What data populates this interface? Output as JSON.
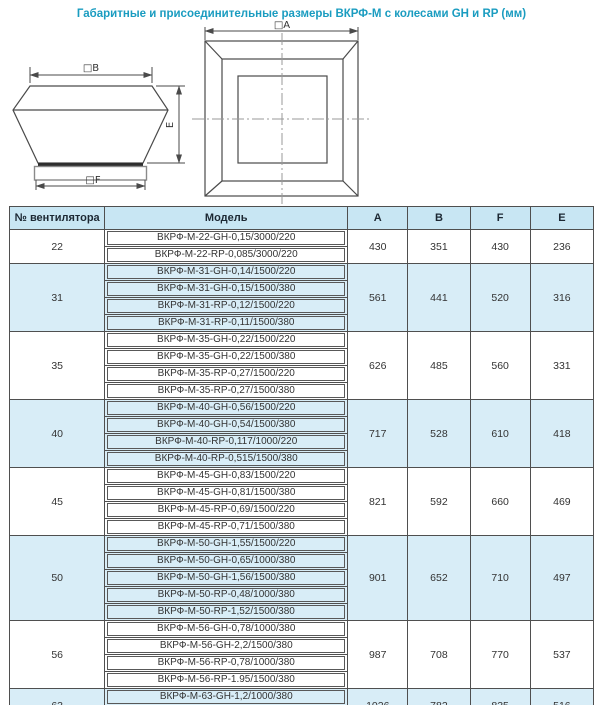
{
  "title": "Габаритные и присоединительные размеры ВКРФ-М с колесами GH и RP (мм)",
  "drawings": {
    "side_view": {
      "dim_top": "□B",
      "dim_right": "E",
      "dim_bottom": "□F"
    },
    "top_view": {
      "dim_top": "□A"
    }
  },
  "table": {
    "headers": {
      "fan_no": "№ вентилятора",
      "model": "Модель",
      "a": "A",
      "b": "B",
      "f": "F",
      "e": "E"
    },
    "groups": [
      {
        "fan_no": "22",
        "models": [
          "ВКРФ-М-22-GH-0,15/3000/220",
          "ВКРФ-М-22-RP-0,085/3000/220"
        ],
        "dims": {
          "A": "430",
          "B": "351",
          "F": "430",
          "E": "236"
        }
      },
      {
        "fan_no": "31",
        "models": [
          "ВКРФ-М-31-GH-0,14/1500/220",
          "ВКРФ-М-31-GH-0,15/1500/380",
          "ВКРФ-М-31-RP-0,12/1500/220",
          "ВКРФ-М-31-RP-0,11/1500/380"
        ],
        "dims": {
          "A": "561",
          "B": "441",
          "F": "520",
          "E": "316"
        }
      },
      {
        "fan_no": "35",
        "models": [
          "ВКРФ-М-35-GH-0,22/1500/220",
          "ВКРФ-М-35-GH-0,22/1500/380",
          "ВКРФ-М-35-RP-0,27/1500/220",
          "ВКРФ-М-35-RP-0,27/1500/380"
        ],
        "dims": {
          "A": "626",
          "B": "485",
          "F": "560",
          "E": "331"
        }
      },
      {
        "fan_no": "40",
        "models": [
          "ВКРФ-М-40-GH-0,56/1500/220",
          "ВКРФ-М-40-GH-0,54/1500/380",
          "ВКРФ-М-40-RP-0,117/1000/220",
          "ВКРФ-М-40-RP-0,515/1500/380"
        ],
        "dims": {
          "A": "717",
          "B": "528",
          "F": "610",
          "E": "418"
        }
      },
      {
        "fan_no": "45",
        "models": [
          "ВКРФ-М-45-GH-0,83/1500/220",
          "ВКРФ-М-45-GH-0,81/1500/380",
          "ВКРФ-М-45-RP-0,69/1500/220",
          "ВКРФ-М-45-RP-0,71/1500/380"
        ],
        "dims": {
          "A": "821",
          "B": "592",
          "F": "660",
          "E": "469"
        }
      },
      {
        "fan_no": "50",
        "models": [
          "ВКРФ-М-50-GH-1,55/1500/220",
          "ВКРФ-М-50-GH-0,65/1000/380",
          "ВКРФ-М-50-GH-1,56/1500/380",
          "ВКРФ-М-50-RP-0,48/1000/380",
          "ВКРФ-М-50-RP-1,52/1500/380"
        ],
        "dims": {
          "A": "901",
          "B": "652",
          "F": "710",
          "E": "497"
        }
      },
      {
        "fan_no": "56",
        "models": [
          "ВКРФ-М-56-GH-0,78/1000/380",
          "ВКРФ-М-56-GH-2,2/1500/380",
          "ВКРФ-М-56-RP-0,78/1000/380",
          "ВКРФ-М-56-RP-1.95/1500/380"
        ],
        "dims": {
          "A": "987",
          "B": "708",
          "F": "770",
          "E": "537"
        }
      },
      {
        "fan_no": "63",
        "models": [
          "ВКРФ-М-63-GH-1,2/1000/380",
          "ВКРФ-М-63-RP-1,31/1000/380"
        ],
        "dims": {
          "A": "1026",
          "B": "782",
          "F": "835",
          "E": "516"
        }
      }
    ]
  },
  "colors": {
    "title": "#1a9cc0",
    "header_bg": "#c8e6f3",
    "alt_row_bg": "#d8edf7",
    "border": "#4f4f4f"
  }
}
